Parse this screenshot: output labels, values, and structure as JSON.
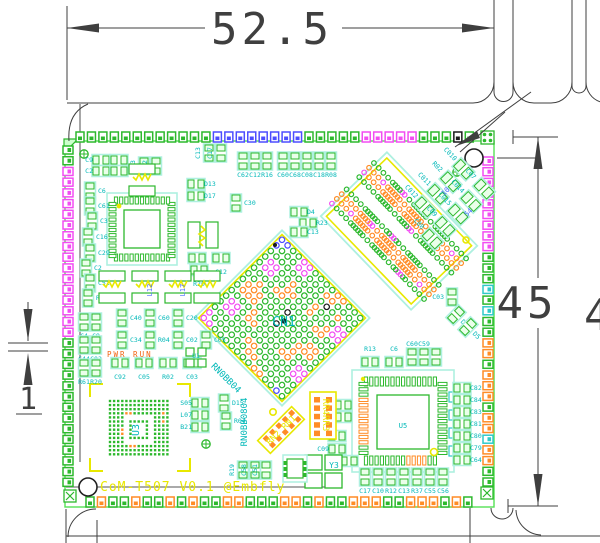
{
  "drawing": {
    "dim_width": "52.5",
    "dim_height": "45",
    "dim_height_partial": "4",
    "dim_pitch": "1"
  },
  "silkscreen": {
    "board_title": "CoM-T507 V0.1 @Embfly",
    "pwr_label": "PWR RUN",
    "rn_label_a": "RN2 RN1",
    "rn_label_b": "RR4RR3"
  },
  "refs": {
    "cn1": "CN1",
    "u3": "U3",
    "u5": "U5",
    "u1": "U1",
    "y3": "Y3",
    "memory_code": "RN0BB0804",
    "memory_code_diag": "RN0BB04",
    "l12": "L12",
    "l17": "L17",
    "pins_a": "10",
    "pins_b": "54"
  },
  "palette": {
    "green": "#2db82d",
    "blue": "#4d4dff",
    "magenta": "#f24df2",
    "orange": "#ff8c26",
    "cyan": "#2ec9c9",
    "black": "#1a1a1a",
    "yellow": "#e8e800",
    "label": "#00b8b8",
    "halo": "#aef0e0",
    "dim": "#3f3f3f",
    "gray": "#8a8a8a",
    "silk_red": "#f2600d",
    "pad_fill": "#eaffea"
  },
  "edge_pads": {
    "top": "ggggggggggggbbbbbbbbgggggmmmmmgggkg",
    "bottom": "goggoggogoggoogggoogoggoooggooogog",
    "left": "ggmmmmmmmmmmmmmmmmgggggggggggggg",
    "right": "mmmmmmmmmgggcgcggoogooogoocoogg"
  },
  "cn1_matrix": [
    "bbggmmggggooggg",
    "bgggmmgggoogggg",
    "ggggggggggkgogg",
    "gmmggogggogggmm",
    "gmmggooggoggomm",
    "ggggoogggggoogg",
    "ggoggggkggggggg",
    "goooggggggggoog",
    "gooogggkgggooog",
    "ggggoggggggoggg",
    "gmmgooggggoogmm",
    "gmmggggggggggmm",
    "ggggggooggggggg",
    "mggggggoogggggg",
    "mmgggggggooggbg"
  ],
  "u3_matrix": [
    "ggggggggggggggg",
    "ggggggggggggggg",
    "ggggggggggggggg",
    "ggggoogggggggog",
    "gggg.......gggg",
    "gggg.ggggg.ggog",
    "gggg.g...g.gggg",
    "gggo.g...g.gggg",
    "gggo.g...g.gggg",
    "gggg.ggggg.gggg",
    "gggg.......gggg",
    "gggggoogggggggg",
    "ggggggggggggggg",
    "ggggggggggggggg"
  ],
  "ddr_labels": {
    "row_a": [
      "C012",
      "C011",
      "R02",
      "C010"
    ],
    "row_b": [
      "C08",
      "C09",
      "C015",
      "C014",
      "C07"
    ]
  },
  "passives": [
    [
      101,
      160,
      "h",
      "C9",
      "l"
    ],
    [
      101,
      171,
      "h",
      "C2",
      "l"
    ],
    [
      119,
      160,
      "h",
      "",
      ""
    ],
    [
      119,
      171,
      "h",
      "",
      ""
    ],
    [
      144,
      166,
      "v",
      "C23",
      "v"
    ],
    [
      156,
      166,
      "v",
      "C22",
      "v"
    ],
    [
      209,
      153,
      "v",
      "C13",
      "v"
    ],
    [
      221,
      153,
      "v",
      "C17",
      "v"
    ],
    [
      243,
      161,
      "v",
      "C62",
      "b"
    ],
    [
      255,
      161,
      "v",
      "C12",
      "b"
    ],
    [
      267,
      161,
      "v",
      "R16",
      "b"
    ],
    [
      283,
      161,
      "v",
      "C60",
      "b"
    ],
    [
      295,
      161,
      "v",
      "C68",
      "b"
    ],
    [
      307,
      161,
      "v",
      "C08",
      "b"
    ],
    [
      319,
      161,
      "v",
      "C18",
      "b"
    ],
    [
      331,
      161,
      "v",
      "R08",
      "b"
    ],
    [
      196,
      184,
      "h",
      "D13",
      "r"
    ],
    [
      196,
      196,
      "h",
      "D17",
      "r"
    ],
    [
      236,
      203,
      "v",
      "C30",
      "r"
    ],
    [
      90,
      191,
      "v",
      "C6",
      "r"
    ],
    [
      90,
      206,
      "v",
      "C61",
      "r"
    ],
    [
      92,
      221,
      "v",
      "C3",
      "r"
    ],
    [
      88,
      237,
      "v",
      "C16",
      "r"
    ],
    [
      90,
      253,
      "v",
      "C29",
      "r"
    ],
    [
      86,
      268,
      "v",
      "C2",
      "r"
    ],
    [
      90,
      283,
      "v",
      "C51",
      "r"
    ],
    [
      88,
      298,
      "v",
      "R6",
      "r"
    ],
    [
      84,
      322,
      "v",
      "C4",
      "b"
    ],
    [
      96,
      322,
      "v",
      "C9",
      "b"
    ],
    [
      84,
      345,
      "v",
      "C44",
      "b"
    ],
    [
      96,
      345,
      "v",
      "C02",
      "b"
    ],
    [
      84,
      368,
      "v",
      "R61",
      "b"
    ],
    [
      96,
      368,
      "v",
      "R20",
      "b"
    ],
    [
      122,
      318,
      "v",
      "C40",
      "r"
    ],
    [
      150,
      318,
      "v",
      "C60",
      "r"
    ],
    [
      178,
      318,
      "v",
      "C20",
      "r"
    ],
    [
      122,
      340,
      "v",
      "C34",
      "r"
    ],
    [
      150,
      340,
      "v",
      "R04",
      "r"
    ],
    [
      178,
      340,
      "v",
      "C02",
      "r"
    ],
    [
      206,
      340,
      "v",
      "C05",
      "r"
    ],
    [
      120,
      363,
      "h",
      "C92",
      "b"
    ],
    [
      144,
      363,
      "h",
      "C05",
      "b"
    ],
    [
      168,
      363,
      "h",
      "R02",
      "b"
    ],
    [
      192,
      363,
      "h",
      "C03",
      "b"
    ],
    [
      299,
      212,
      "h",
      "D4",
      "r"
    ],
    [
      308,
      223,
      "h",
      "R23",
      "r"
    ],
    [
      299,
      232,
      "h",
      "C13",
      "r"
    ],
    [
      197,
      258,
      "h",
      "C27",
      "b"
    ],
    [
      221,
      258,
      "h",
      "C12",
      "b"
    ],
    [
      199,
      270,
      "h",
      "R20",
      "b"
    ],
    [
      452,
      297,
      "v",
      "C03",
      "l"
    ],
    [
      456,
      315,
      "d",
      "D6",
      "r"
    ],
    [
      468,
      327,
      "d",
      "D5",
      "r"
    ],
    [
      243,
      470,
      "v",
      "R19",
      "v"
    ],
    [
      255,
      470,
      "v",
      "C58",
      "v"
    ],
    [
      266,
      470,
      "v",
      "C51",
      "v"
    ],
    [
      343,
      405,
      "h",
      "C011",
      "l"
    ],
    [
      343,
      417,
      "h",
      "C05",
      "l"
    ],
    [
      337,
      436,
      "h",
      "C28",
      "l"
    ],
    [
      337,
      449,
      "h",
      "C09",
      "l"
    ],
    [
      349,
      461,
      "h",
      "C29",
      "l"
    ],
    [
      370,
      362,
      "h",
      "R13",
      "a"
    ],
    [
      394,
      362,
      "h",
      "C6",
      "a"
    ],
    [
      412,
      357,
      "v",
      "C60",
      "a"
    ],
    [
      424,
      357,
      "v",
      "C59",
      "a"
    ],
    [
      436,
      357,
      "v",
      "",
      ""
    ],
    [
      462,
      388,
      "h",
      "C82",
      "r"
    ],
    [
      462,
      400,
      "h",
      "C84",
      "r"
    ],
    [
      462,
      412,
      "h",
      "C83",
      "r"
    ],
    [
      462,
      424,
      "h",
      "C81",
      "r"
    ],
    [
      462,
      436,
      "h",
      "C80",
      "r"
    ],
    [
      462,
      448,
      "h",
      "C79",
      "r"
    ],
    [
      462,
      460,
      "h",
      "C64",
      "r"
    ],
    [
      365,
      477,
      "v",
      "C17",
      "b"
    ],
    [
      378,
      477,
      "v",
      "C10",
      "b"
    ],
    [
      391,
      477,
      "v",
      "R12",
      "b"
    ],
    [
      404,
      477,
      "v",
      "C13",
      "b"
    ],
    [
      417,
      477,
      "v",
      "R37",
      "b"
    ],
    [
      430,
      477,
      "v",
      "C55",
      "b"
    ],
    [
      443,
      477,
      "v",
      "C56",
      "b"
    ],
    [
      200,
      403,
      "h",
      "S05",
      "l"
    ],
    [
      200,
      415,
      "h",
      "L07",
      "l"
    ],
    [
      200,
      427,
      "h",
      "B21",
      "l"
    ],
    [
      224,
      403,
      "v",
      "D15",
      "r"
    ],
    [
      226,
      421,
      "v",
      "R04",
      "r"
    ]
  ],
  "inductor_row_x": [
    112,
    145,
    178,
    207
  ],
  "inductor_row_y": 287
}
